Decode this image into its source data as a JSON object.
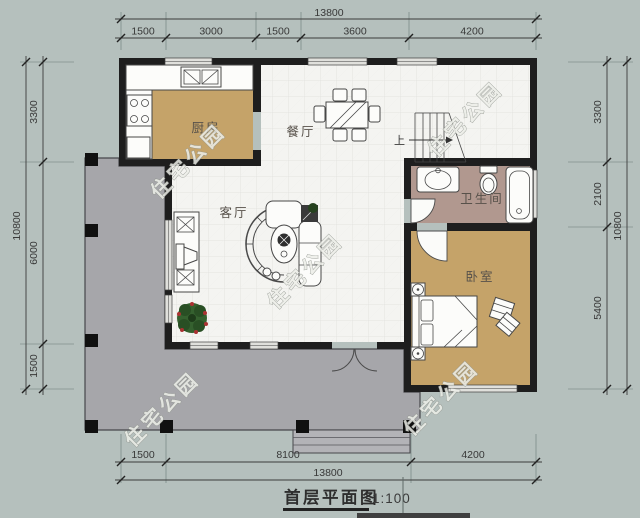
{
  "title": {
    "text": "首层平面图",
    "scale": "1:100"
  },
  "watermark": {
    "text": "住宅公园"
  },
  "rooms": {
    "kitchen": "厨房",
    "dining": "餐厅",
    "living": "客厅",
    "bathroom": "卫生间",
    "bedroom": "卧室"
  },
  "stairs": {
    "up_label": "上"
  },
  "dimensions": {
    "top": {
      "total": "13800",
      "segments": [
        "1500",
        "3000",
        "1500",
        "3600",
        "4200"
      ]
    },
    "bottom": {
      "total": "13800",
      "segments": [
        "1500",
        "8100",
        "4200"
      ]
    },
    "left": {
      "total": "10800",
      "segments": [
        "3300",
        "6000",
        "1500"
      ]
    },
    "right": {
      "total": "10800",
      "segments": [
        "3300",
        "2100",
        "5400"
      ]
    }
  },
  "colors": {
    "background": "#b5c0bd",
    "porch": "#a6a6aa",
    "wall": "#1e1e1e",
    "tile_floor": "#f4f4f1",
    "wood_floor": "#c5a369",
    "bath_floor": "#b1988f",
    "watermark": "#edefe9",
    "dimension_text": "#383838"
  }
}
